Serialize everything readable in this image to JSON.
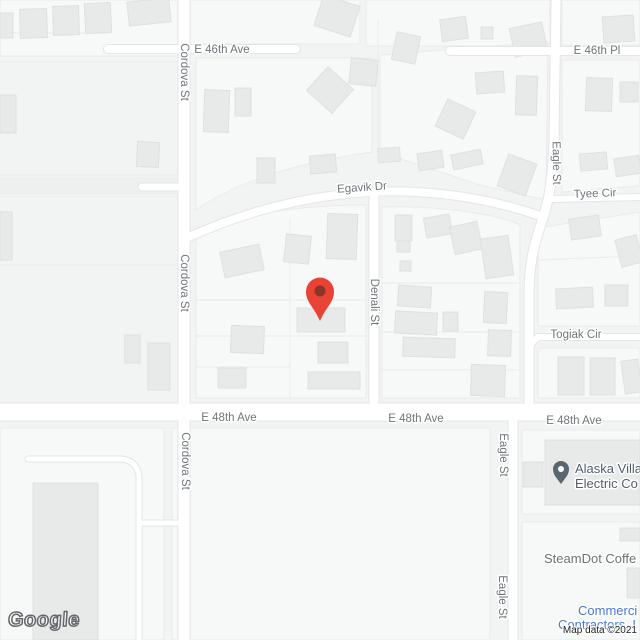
{
  "ui": {
    "google_logo": "Google",
    "attribution": "Map data ©2021"
  },
  "colors": {
    "land": "#f2f3f3",
    "block_fill": "#f7f8f8",
    "block_stroke": "#e9ebec",
    "parcel_line": "#e9ebec",
    "building_fill": "#e8e9e9",
    "building_stroke": "#dfe0e1",
    "road_fill": "#ffffff",
    "road_casing": "#e3e5e7",
    "gray_band": "#eef0f0",
    "road_label": "#70757a",
    "marker_red": "#e94335",
    "marker_inner": "#8e3327",
    "poi_pin": "#5a6773",
    "poi_pin_dot": "#ffffff",
    "poi_dark": "#52606c",
    "poi_gray": "#6d7277",
    "poi_blue": "#4a78d4",
    "halo": "#ffffff"
  },
  "blocks": [
    {
      "id": "block-n-west",
      "d": "M0,0 L178,0 L178,56 L0,56 Z"
    },
    {
      "id": "block-n-mid",
      "d": "M190,0 L360,0 L360,44 L190,44 Z"
    },
    {
      "id": "block-n-east",
      "d": "M366,0 L550,0 L550,46 L366,46 Z"
    },
    {
      "id": "block-n-far-east",
      "d": "M562,0 L640,0 L640,45 L562,45 Z"
    },
    {
      "id": "block-46-egavik-w",
      "d": "M196,58 L372,58 L372,152 C330,158 250,172 196,210 Z"
    },
    {
      "id": "block-46-egavik-e",
      "d": "M380,55 L548,42 L546,200 L480,185 L380,152 Z"
    },
    {
      "id": "block-ne-46pl",
      "d": "M562,60 L640,60 L640,186 L562,192 Z"
    },
    {
      "id": "block-pin",
      "d": "M196,228 C260,210 320,205 366,205 L366,398 L196,398 Z"
    },
    {
      "id": "block-denali-eagle",
      "d": "M382,207 C440,205 500,215 520,225 L520,398 L382,398 Z"
    },
    {
      "id": "block-tyee-togiak",
      "d": "M538,228 L640,212 L640,326 L538,326 Z"
    },
    {
      "id": "block-togiak-48",
      "d": "M538,348 L640,348 L640,398 L538,398 Z"
    },
    {
      "id": "block-sw",
      "d": "M0,428 L164,428 L164,640 L0,640 Z"
    },
    {
      "id": "block-s-mid",
      "d": "M172,428 L490,428 L490,640 L172,640 Z"
    },
    {
      "id": "block-se-upper",
      "d": "M522,430 L640,430 L640,514 L522,514 Z"
    },
    {
      "id": "block-se-lower",
      "d": "M522,522 L640,522 L640,640 L522,640 Z"
    }
  ],
  "parcel_lines": [
    "M0,33 L110,33",
    "M0,62 L178,62",
    "M0,175 L178,175",
    "M0,197 L178,197",
    "M290,218 L290,398",
    "M196,300 L366,300",
    "M196,336 L366,336",
    "M196,367 L290,367",
    "M380,283 L520,283",
    "M380,332 L520,332",
    "M380,370 L520,370",
    "M378,20 L378,150",
    "M538,260 L640,256",
    "M0,265 L176,265"
  ],
  "buildings": [
    [
      0,
      13,
      13,
      25,
      0
    ],
    [
      20,
      9,
      27,
      29,
      -2
    ],
    [
      53,
      6,
      26,
      29,
      -2
    ],
    [
      85,
      3,
      26,
      30,
      -3
    ],
    [
      128,
      0,
      42,
      24,
      -6
    ],
    [
      318,
      0,
      38,
      32,
      18
    ],
    [
      394,
      34,
      24,
      28,
      12
    ],
    [
      441,
      18,
      26,
      22,
      -8
    ],
    [
      512,
      25,
      33,
      29,
      -12
    ],
    [
      481,
      27,
      12,
      12,
      0
    ],
    [
      603,
      16,
      31,
      26,
      -4
    ],
    [
      0,
      95,
      16,
      38,
      0
    ],
    [
      204,
      90,
      25,
      42,
      2
    ],
    [
      235,
      88,
      16,
      28,
      0
    ],
    [
      313,
      74,
      34,
      32,
      42
    ],
    [
      350,
      59,
      27,
      26,
      6
    ],
    [
      440,
      104,
      31,
      30,
      25
    ],
    [
      137,
      142,
      22,
      25,
      3
    ],
    [
      257,
      158,
      18,
      25,
      0
    ],
    [
      310,
      155,
      26,
      18,
      -5
    ],
    [
      378,
      148,
      22,
      14,
      -4
    ],
    [
      418,
      152,
      25,
      17,
      -8
    ],
    [
      452,
      152,
      30,
      15,
      -12
    ],
    [
      502,
      158,
      30,
      34,
      20
    ],
    [
      580,
      153,
      27,
      17,
      -5
    ],
    [
      615,
      157,
      25,
      18,
      -8
    ],
    [
      476,
      72,
      28,
      21,
      -4
    ],
    [
      516,
      76,
      21,
      39,
      2
    ],
    [
      586,
      78,
      26,
      33,
      2
    ],
    [
      620,
      82,
      18,
      20,
      0
    ],
    [
      570,
      217,
      30,
      21,
      -8
    ],
    [
      618,
      237,
      22,
      28,
      -15
    ],
    [
      0,
      212,
      12,
      48,
      0
    ],
    [
      222,
      248,
      40,
      26,
      -12
    ],
    [
      285,
      235,
      25,
      28,
      6
    ],
    [
      327,
      214,
      30,
      45,
      2
    ],
    [
      231,
      326,
      33,
      27,
      2
    ],
    [
      218,
      368,
      28,
      20,
      0
    ],
    [
      297,
      308,
      48,
      24,
      0
    ],
    [
      318,
      342,
      30,
      21,
      0
    ],
    [
      308,
      372,
      52,
      17,
      0
    ],
    [
      125,
      335,
      15,
      28,
      0
    ],
    [
      148,
      343,
      22,
      47,
      0
    ],
    [
      395,
      215,
      17,
      26,
      0
    ],
    [
      397,
      241,
      13,
      11,
      0
    ],
    [
      400,
      261,
      11,
      10,
      0
    ],
    [
      425,
      216,
      26,
      20,
      -10
    ],
    [
      452,
      224,
      28,
      28,
      -12
    ],
    [
      483,
      237,
      28,
      40,
      -8
    ],
    [
      398,
      286,
      33,
      21,
      4
    ],
    [
      395,
      312,
      42,
      22,
      3
    ],
    [
      443,
      312,
      15,
      19,
      0
    ],
    [
      403,
      338,
      52,
      19,
      2
    ],
    [
      484,
      292,
      23,
      31,
      3
    ],
    [
      488,
      330,
      23,
      26,
      2
    ],
    [
      471,
      365,
      34,
      31,
      2
    ],
    [
      556,
      288,
      37,
      20,
      -3
    ],
    [
      605,
      285,
      23,
      21,
      0
    ],
    [
      558,
      357,
      26,
      38,
      0
    ],
    [
      590,
      358,
      25,
      37,
      0
    ],
    [
      623,
      360,
      17,
      33,
      -8
    ],
    [
      33,
      483,
      65,
      157,
      0
    ],
    [
      523,
      462,
      20,
      25,
      0
    ],
    [
      545,
      440,
      95,
      65,
      0
    ],
    [
      627,
      568,
      13,
      30,
      0
    ],
    [
      620,
      528,
      20,
      13,
      0
    ]
  ],
  "roads": [
    {
      "id": "cordova-st",
      "d": "M184,0 L184,640",
      "w": 11
    },
    {
      "id": "e-46th-ave",
      "d": "M108,49 L296,49",
      "w": 8
    },
    {
      "id": "e-46th-pl",
      "d": "M450,51 L640,51",
      "w": 8
    },
    {
      "id": "eagle-st-north",
      "d": "M556,0 L554,140 C552,185 549,200 543,218 C534,244 530,260 529,290 L529,406",
      "w": 9
    },
    {
      "id": "denali-st",
      "d": "M374,192 L374,406",
      "w": 9
    },
    {
      "id": "egavik-dr",
      "d": "M189,237 C240,214 300,196 370,192 C430,189 490,198 543,217",
      "w": 8
    },
    {
      "id": "e-48th-ave",
      "d": "M0,412 L640,412",
      "w": 17
    },
    {
      "id": "eagle-st-south",
      "d": "M513,421 L513,640",
      "w": 9
    },
    {
      "id": "tyee-cir",
      "d": "M552,199 L640,197",
      "w": 6
    },
    {
      "id": "togiak-cir",
      "d": "M531,344 L538,337 L640,337",
      "w": 6
    },
    {
      "id": "stub-west-cordova",
      "d": "M142,187 L180,187",
      "w": 7
    },
    {
      "id": "lane-southwest",
      "d": "M28,459 L122,459 Q138,461 139,478 L139,640",
      "w": 5
    },
    {
      "id": "lane-southwest-spur",
      "d": "M139,523 L180,523",
      "w": 5
    }
  ],
  "gray_band": {
    "d": "M0,186 L178,186",
    "w": 18
  },
  "street_labels": [
    {
      "text": "E 46th Ave",
      "x": 222,
      "y": 50,
      "rot": 0
    },
    {
      "text": "E 46th Pl",
      "x": 597,
      "y": 51,
      "rot": 0
    },
    {
      "text": "Cordova St",
      "x": 184,
      "y": 72,
      "rot": 90
    },
    {
      "text": "Cordova St",
      "x": 184,
      "y": 283,
      "rot": 90
    },
    {
      "text": "Cordova St",
      "x": 185,
      "y": 461,
      "rot": 90
    },
    {
      "text": "Egavik Dr",
      "x": 362,
      "y": 188,
      "rot": -4
    },
    {
      "text": "Eagle St",
      "x": 556,
      "y": 163,
      "rot": 89
    },
    {
      "text": "Tyee Cir",
      "x": 595,
      "y": 194,
      "rot": -2
    },
    {
      "text": "Denali St",
      "x": 374,
      "y": 302,
      "rot": 90
    },
    {
      "text": "Togiak Cir",
      "x": 576,
      "y": 335,
      "rot": 0
    },
    {
      "text": "E 48th Ave",
      "x": 229,
      "y": 418,
      "rot": 0
    },
    {
      "text": "E 48th Ave",
      "x": 416,
      "y": 419,
      "rot": 0
    },
    {
      "text": "E 48th Ave",
      "x": 574,
      "y": 421,
      "rot": 0
    },
    {
      "text": "Eagle St",
      "x": 503,
      "y": 455,
      "rot": 90
    },
    {
      "text": "Eagle St",
      "x": 502,
      "y": 597,
      "rot": 90
    }
  ],
  "pois": [
    {
      "id": "alaska-village-electric",
      "pin": {
        "x": 561,
        "y": 484
      },
      "color": "poi_dark",
      "lines": [
        {
          "text": "Alaska Villa",
          "x": 575,
          "y": 473
        },
        {
          "text": "Electric Co",
          "x": 575,
          "y": 488
        }
      ]
    },
    {
      "id": "steamdot-coffee",
      "color": "poi_gray",
      "lines": [
        {
          "text": "SteamDot Coffe",
          "x": 544,
          "y": 563
        }
      ]
    },
    {
      "id": "commercial-contractors",
      "color": "poi_blue",
      "lines": [
        {
          "text": "Commerci",
          "x": 578,
          "y": 615
        },
        {
          "text": "Contractors, I",
          "x": 558,
          "y": 629
        }
      ]
    }
  ],
  "marker": {
    "tip_x": 320,
    "tip_y": 321
  }
}
